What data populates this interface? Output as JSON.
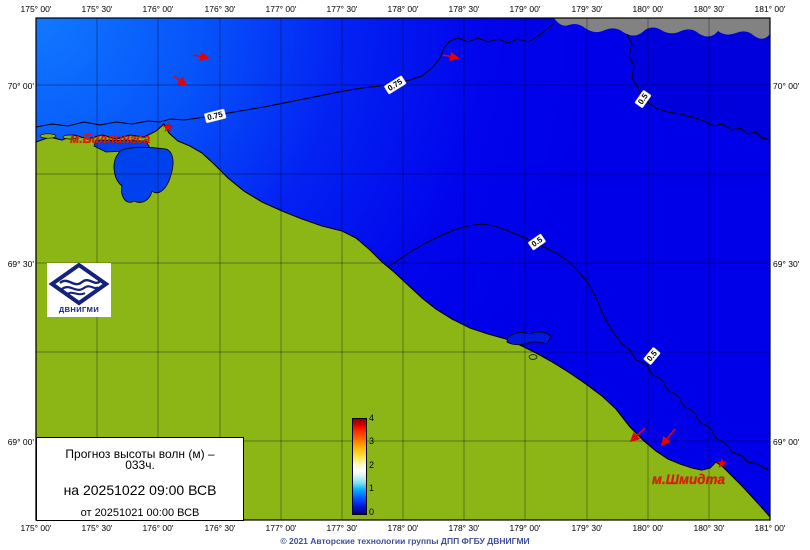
{
  "title_block": {
    "line1": "Прогноз высоты волн (м) –",
    "line2": "033ч.",
    "valid": "на 20251022 09:00 ВСВ",
    "issued": "от 20251021 00:00 ВСВ"
  },
  "axes": {
    "lon_ticks": [
      "175° 00'",
      "175° 30'",
      "176° 00'",
      "176° 30'",
      "177° 00'",
      "177° 30'",
      "178° 00'",
      "178° 30'",
      "179° 00'",
      "179° 30'",
      "180° 00'",
      "180° 30'",
      "181° 00'"
    ],
    "lat_ticks": [
      "70° 00'",
      "69° 30'",
      "69° 00'"
    ]
  },
  "places": {
    "billings": "м.Биллингса",
    "shmidt": "м.Шмидта"
  },
  "contours": {
    "c075": "0.75",
    "c05": "0.5"
  },
  "colorbar": {
    "unit": "м",
    "min": 0,
    "max": 4,
    "ticks": [
      "4",
      "3",
      "2",
      "1",
      "0"
    ]
  },
  "logo": {
    "name": "ДВНИГМИ"
  },
  "footer": {
    "copyright": "© 2021 Авторские технологии группы ДПП ФГБУ ДВНИГМИ"
  },
  "colors": {
    "sea_light": "#1179ff",
    "sea_deep": "#0000e8",
    "land": "#8cb616",
    "no_data": "#828282",
    "label_red": "#e81400",
    "copyright_blue": "#3d4f9d"
  }
}
